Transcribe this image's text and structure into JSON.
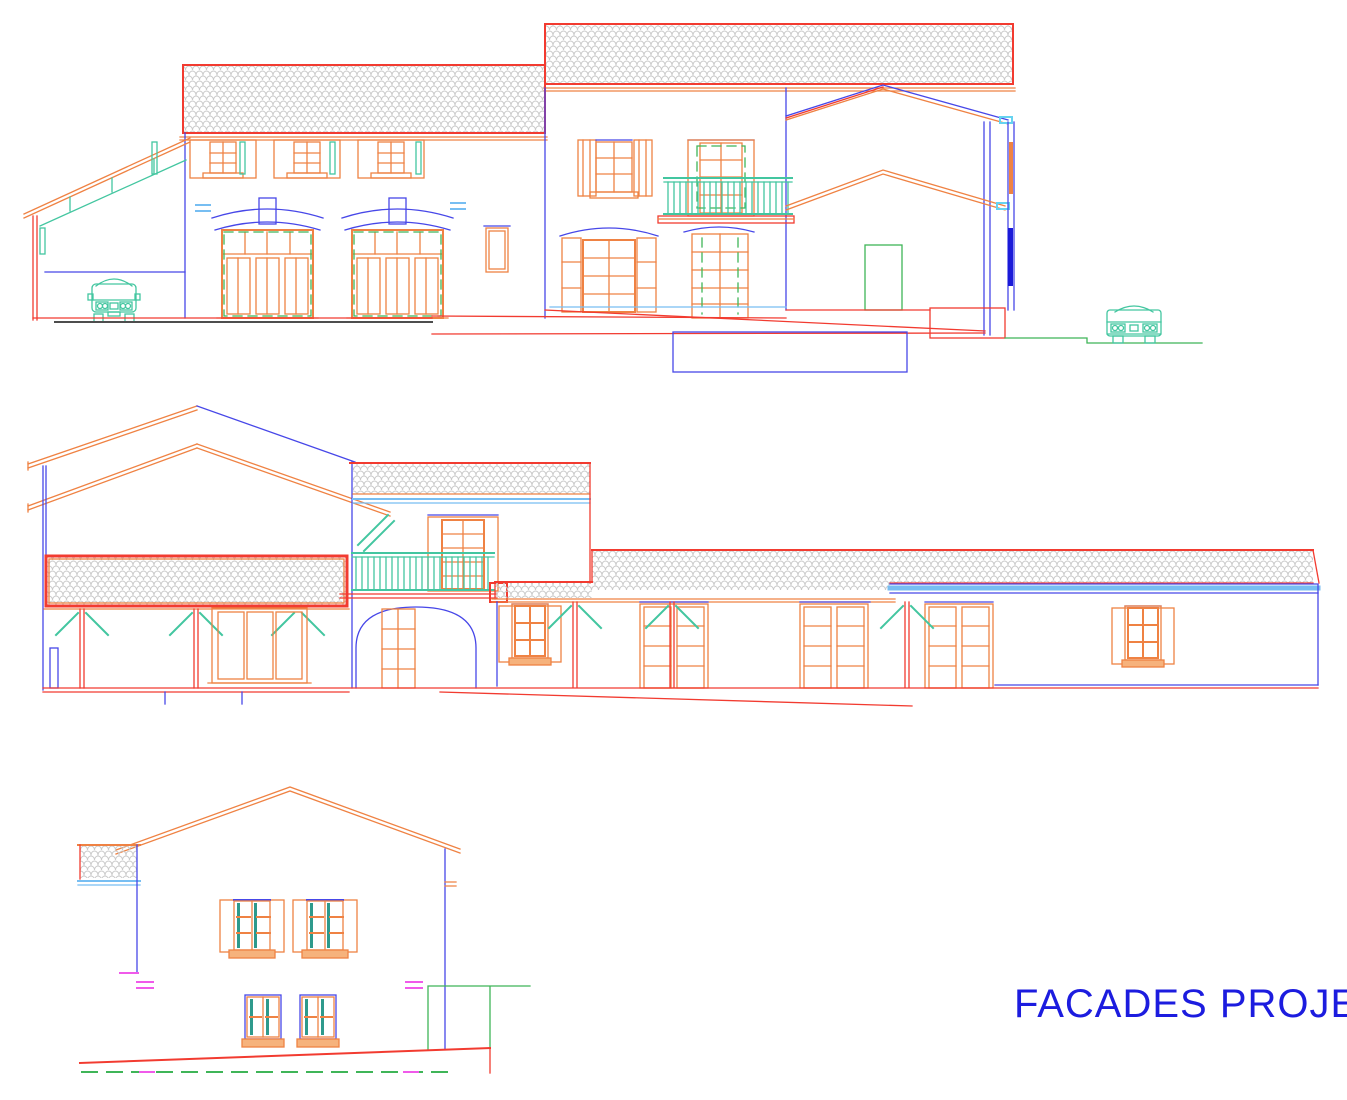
{
  "title": {
    "label": "FACADES PROJET"
  },
  "colors": {
    "orange": "#EF8243",
    "red": "#F23B30",
    "blue": "#4747E8",
    "bluedark": "#1A1AD8",
    "teal": "#43C6A0",
    "tealdark": "#2E9A8C",
    "green": "#3FB558",
    "sky": "#77BEF2",
    "cyan": "#66D3F0",
    "magenta": "#F05AEA",
    "hatch": "#C9C9C9",
    "dark": "#4D4D4D",
    "sill": "#F6B27C",
    "title": "#1C1CDF",
    "background": "#FFFFFF"
  }
}
